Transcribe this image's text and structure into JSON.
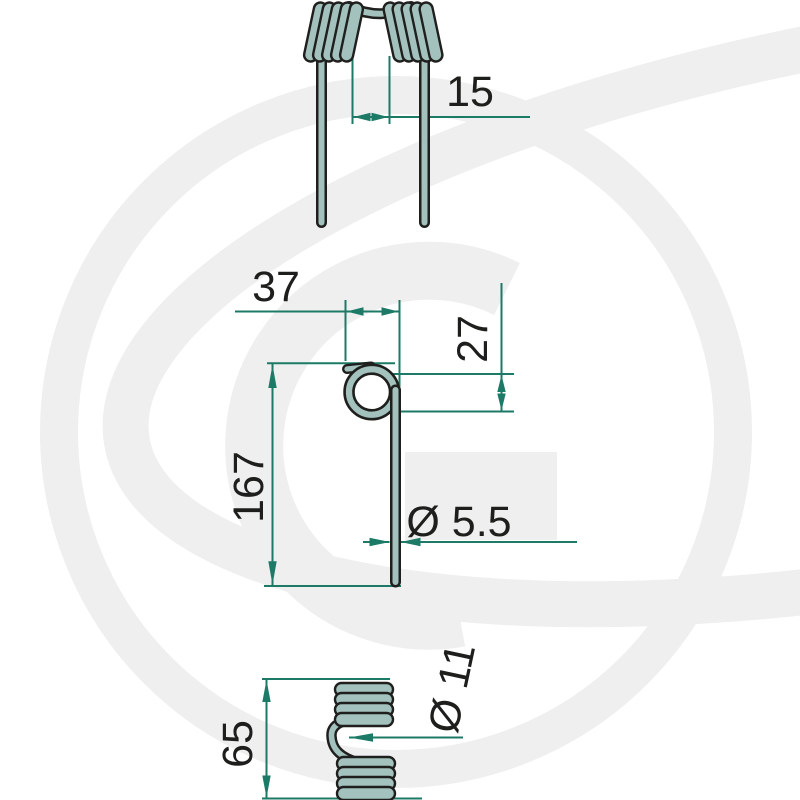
{
  "drawing": {
    "description": "Technical dimension drawing of a double torsion spring tine in three views",
    "watermark_letter": "G",
    "views": {
      "front": {
        "dims": {
          "tine_gap": "15"
        }
      },
      "side": {
        "dims": {
          "top_width": "37",
          "coil_offset": "27",
          "leg_length": "167",
          "wire_diameter": "Ø 5.5"
        }
      },
      "end": {
        "dims": {
          "coil_block_length": "65",
          "coil_diameter": "Ø 11"
        }
      }
    },
    "colors": {
      "background": "#ffffff",
      "watermark": "#efefef",
      "dimension_lines": "#1c7a67",
      "wire_fill": "#a3c1bd",
      "wire_outline": "#1f1f1d",
      "label_text": "#1e1e1c"
    }
  }
}
